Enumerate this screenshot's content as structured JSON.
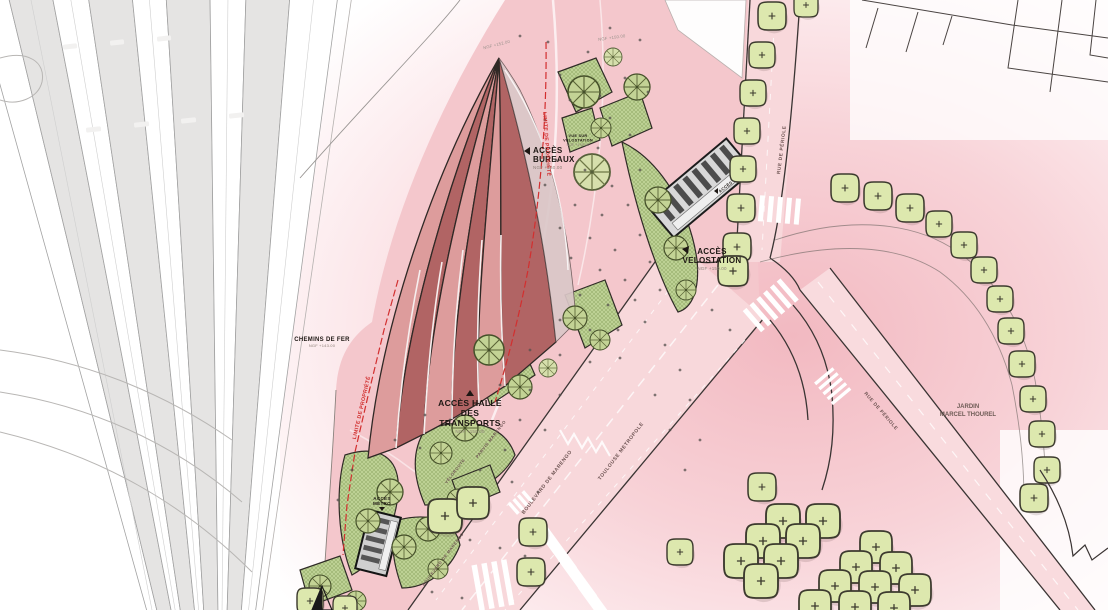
{
  "title": "plan masse parvis / halle des transports",
  "colors": {
    "roof_light": "#dd9c9c",
    "roof_dark": "#b16464",
    "roof_overhang": "#dbc7c8",
    "plaza_pink": "#f4c7cc",
    "road_pink": "#f8d8db",
    "pink_wash": "#f2bac2",
    "rail_gray": "#e5e4e3",
    "green_hatch": "#bdd194",
    "tree_round": "#c3d395",
    "tree_simple": "#dde8ae",
    "outline": "#2f2825",
    "limit_red": "#d22f2f"
  },
  "labels": {
    "acces_bureaux": {
      "line1": "ACCÈS",
      "line2": "BUREAUX",
      "sub": "NGF +150.00"
    },
    "acces_velostation": {
      "line1": "ACCÈS",
      "line2": "VELOSTATION",
      "sub": "NGF +150.00"
    },
    "acces_halle": {
      "line1": "ACCÈS HALLE",
      "line2": "DES",
      "line3": "TRANSPORTS",
      "sub": "NGF +150.00"
    },
    "acces_metro": {
      "line1": "ACCÈS",
      "line2": "MÉTRO"
    },
    "acces_top": {
      "line1": "ACCÈS"
    },
    "chemins_de_fer": {
      "line1": "CHEMINS DE FER",
      "sub": "NGF +143.00"
    },
    "jardin": {
      "line1": "JARDIN",
      "line2": "MARCEL THOUREL"
    },
    "vue_velostation": {
      "line1": "VUE SUR",
      "line2": "VELOSTATION",
      "sub": "NGF +145.00"
    },
    "limite_propriete": "LIMITE DE PROPRIÉTÉ",
    "boulevard": "BOULEVARD DE MARENGO",
    "metropole": "TOULOUSE METROPOLE",
    "parvis": "PARVIS MARENGO",
    "veloroute": "VÉLOROUTE",
    "rue_periole_top": "RUE DE PÉRIOLE",
    "rue_periole_diag": "RUE DE PÉRIOLE",
    "ngf_apex": "NGF +152.00",
    "ngf_top": "NGF +150.00"
  },
  "map": {
    "trees_simple": [
      [
        772,
        16,
        14
      ],
      [
        806,
        5,
        12
      ],
      [
        762,
        55,
        13
      ],
      [
        753,
        93,
        13
      ],
      [
        747,
        131,
        13
      ],
      [
        743,
        169,
        13
      ],
      [
        741,
        208,
        14
      ],
      [
        737,
        247,
        14
      ],
      [
        733,
        271,
        15
      ],
      [
        845,
        188,
        14
      ],
      [
        878,
        196,
        14
      ],
      [
        910,
        208,
        14
      ],
      [
        939,
        224,
        13
      ],
      [
        964,
        245,
        13
      ],
      [
        984,
        270,
        13
      ],
      [
        1000,
        299,
        13
      ],
      [
        1011,
        331,
        13
      ],
      [
        1022,
        364,
        13
      ],
      [
        1033,
        399,
        13
      ],
      [
        1042,
        434,
        13
      ],
      [
        1047,
        470,
        13
      ],
      [
        1034,
        498,
        14
      ],
      [
        445,
        516,
        17
      ],
      [
        473,
        503,
        16
      ],
      [
        533,
        532,
        14
      ],
      [
        531,
        572,
        14
      ],
      [
        680,
        552,
        13
      ],
      [
        762,
        487,
        14
      ],
      [
        783,
        521,
        17
      ],
      [
        823,
        521,
        17
      ],
      [
        763,
        541,
        17
      ],
      [
        803,
        541,
        17
      ],
      [
        741,
        561,
        17
      ],
      [
        781,
        561,
        17
      ],
      [
        761,
        581,
        17
      ],
      [
        876,
        547,
        16
      ],
      [
        856,
        567,
        16
      ],
      [
        896,
        568,
        16
      ],
      [
        835,
        586,
        16
      ],
      [
        875,
        587,
        16
      ],
      [
        915,
        590,
        16
      ],
      [
        815,
        606,
        16
      ],
      [
        855,
        607,
        16
      ],
      [
        894,
        608,
        16
      ],
      [
        310,
        601,
        13
      ],
      [
        345,
        608,
        12
      ]
    ],
    "trees_round_a": [
      [
        584,
        92,
        16
      ],
      [
        637,
        87,
        13
      ],
      [
        601,
        128,
        10
      ],
      [
        658,
        200,
        13
      ],
      [
        676,
        248,
        12
      ],
      [
        686,
        290,
        10
      ],
      [
        575,
        318,
        12
      ],
      [
        600,
        340,
        10
      ],
      [
        489,
        350,
        15
      ],
      [
        520,
        387,
        12
      ],
      [
        465,
        428,
        13
      ],
      [
        441,
        453,
        11
      ],
      [
        390,
        492,
        13
      ],
      [
        368,
        521,
        12
      ],
      [
        428,
        529,
        12
      ],
      [
        404,
        547,
        12
      ],
      [
        458,
        500,
        11
      ],
      [
        438,
        569,
        10
      ],
      [
        320,
        586,
        11
      ],
      [
        356,
        601,
        10
      ]
    ],
    "trees_round_b": [
      [
        592,
        172,
        18
      ],
      [
        613,
        57,
        9
      ],
      [
        548,
        368,
        9
      ]
    ],
    "dots": [
      [
        520,
        36
      ],
      [
        548,
        42
      ],
      [
        610,
        28
      ],
      [
        588,
        52
      ],
      [
        640,
        40
      ],
      [
        560,
        75
      ],
      [
        625,
        78
      ],
      [
        648,
        92
      ],
      [
        600,
        96
      ],
      [
        570,
        100
      ],
      [
        545,
        120
      ],
      [
        610,
        118
      ],
      [
        630,
        135
      ],
      [
        598,
        148
      ],
      [
        556,
        160
      ],
      [
        585,
        170
      ],
      [
        545,
        185
      ],
      [
        612,
        186
      ],
      [
        640,
        170
      ],
      [
        575,
        205
      ],
      [
        602,
        215
      ],
      [
        628,
        205
      ],
      [
        560,
        228
      ],
      [
        590,
        238
      ],
      [
        615,
        250
      ],
      [
        640,
        235
      ],
      [
        571,
        258
      ],
      [
        600,
        270
      ],
      [
        625,
        280
      ],
      [
        650,
        262
      ],
      [
        580,
        295
      ],
      [
        608,
        305
      ],
      [
        635,
        300
      ],
      [
        660,
        290
      ],
      [
        560,
        320
      ],
      [
        590,
        330
      ],
      [
        618,
        330
      ],
      [
        645,
        322
      ],
      [
        530,
        350
      ],
      [
        560,
        355
      ],
      [
        590,
        362
      ],
      [
        620,
        358
      ],
      [
        500,
        385
      ],
      [
        530,
        390
      ],
      [
        560,
        395
      ],
      [
        425,
        415
      ],
      [
        450,
        420
      ],
      [
        395,
        440
      ],
      [
        420,
        448
      ],
      [
        520,
        420
      ],
      [
        545,
        430
      ],
      [
        505,
        450
      ],
      [
        480,
        470
      ],
      [
        512,
        482
      ],
      [
        538,
        492
      ],
      [
        470,
        540
      ],
      [
        500,
        548
      ],
      [
        525,
        556
      ],
      [
        432,
        592
      ],
      [
        462,
        598
      ],
      [
        352,
        470
      ],
      [
        338,
        500
      ],
      [
        665,
        345
      ],
      [
        680,
        370
      ],
      [
        655,
        395
      ],
      [
        690,
        400
      ],
      [
        670,
        430
      ],
      [
        700,
        440
      ],
      [
        685,
        470
      ],
      [
        712,
        310
      ],
      [
        730,
        330
      ]
    ]
  }
}
